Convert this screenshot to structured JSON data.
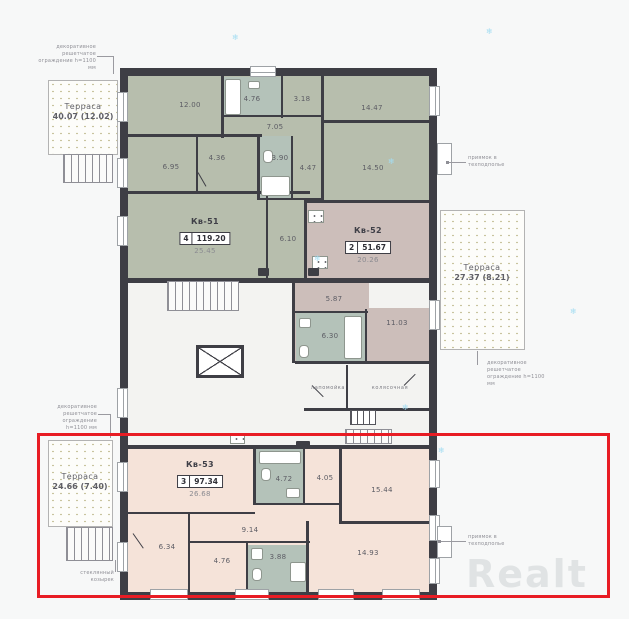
{
  "apartments": {
    "kv51": {
      "name": "Кв-51",
      "rooms_count": "4",
      "total_area": "119.20",
      "main_room_area": "25.45",
      "areas": {
        "r1": "12.00",
        "bath": "4.76",
        "wc": "3.18",
        "bed1": "14.47",
        "hall": "7.05",
        "h1": "6.95",
        "h2": "4.36",
        "bath2": "3.90",
        "h3": "4.47",
        "bed2": "14.50",
        "corridor": "6.10"
      }
    },
    "kv52": {
      "name": "Кв-52",
      "rooms_count": "2",
      "total_area": "51.67",
      "main_room_area": "20.26",
      "areas": {
        "hall": "5.87",
        "kitchen": "11.03",
        "bath": "6.30"
      }
    },
    "kv53": {
      "name": "Кв-53",
      "rooms_count": "3",
      "total_area": "97.34",
      "main_room_area": "26.68",
      "areas": {
        "bath": "4.72",
        "wc": "4.05",
        "bed1": "15.44",
        "hall": "9.14",
        "h1": "6.34",
        "h2": "4.76",
        "bath2": "3.88",
        "bed2": "14.93"
      }
    }
  },
  "common_rooms": {
    "paw_wash": "лапомойка",
    "stroller": "колясочная"
  },
  "terraces": {
    "top_left": {
      "title": "Терраса",
      "area": "40.07 (12.02)"
    },
    "right": {
      "title": "Терраса",
      "area": "27.37 (8.21)"
    },
    "bottom_left": {
      "title": "Терраса",
      "area": "24.66 (7.40)"
    }
  },
  "annotations": {
    "fence": "декоративное решетчатое ограждение h=1100 мм",
    "pit": "приямок в техподполье",
    "canopy": "стеклянный козырек"
  },
  "watermark": "Realt",
  "icons": {
    "snowflake": "❄"
  },
  "highlight": {
    "selection_color": "#e81c24"
  },
  "colors": {
    "kv51": "#b7bead",
    "kv52": "#ccbeba",
    "kv53": "#f5e3d9",
    "wet_room": "#b4c2b9",
    "wall": "#3e3e45"
  }
}
